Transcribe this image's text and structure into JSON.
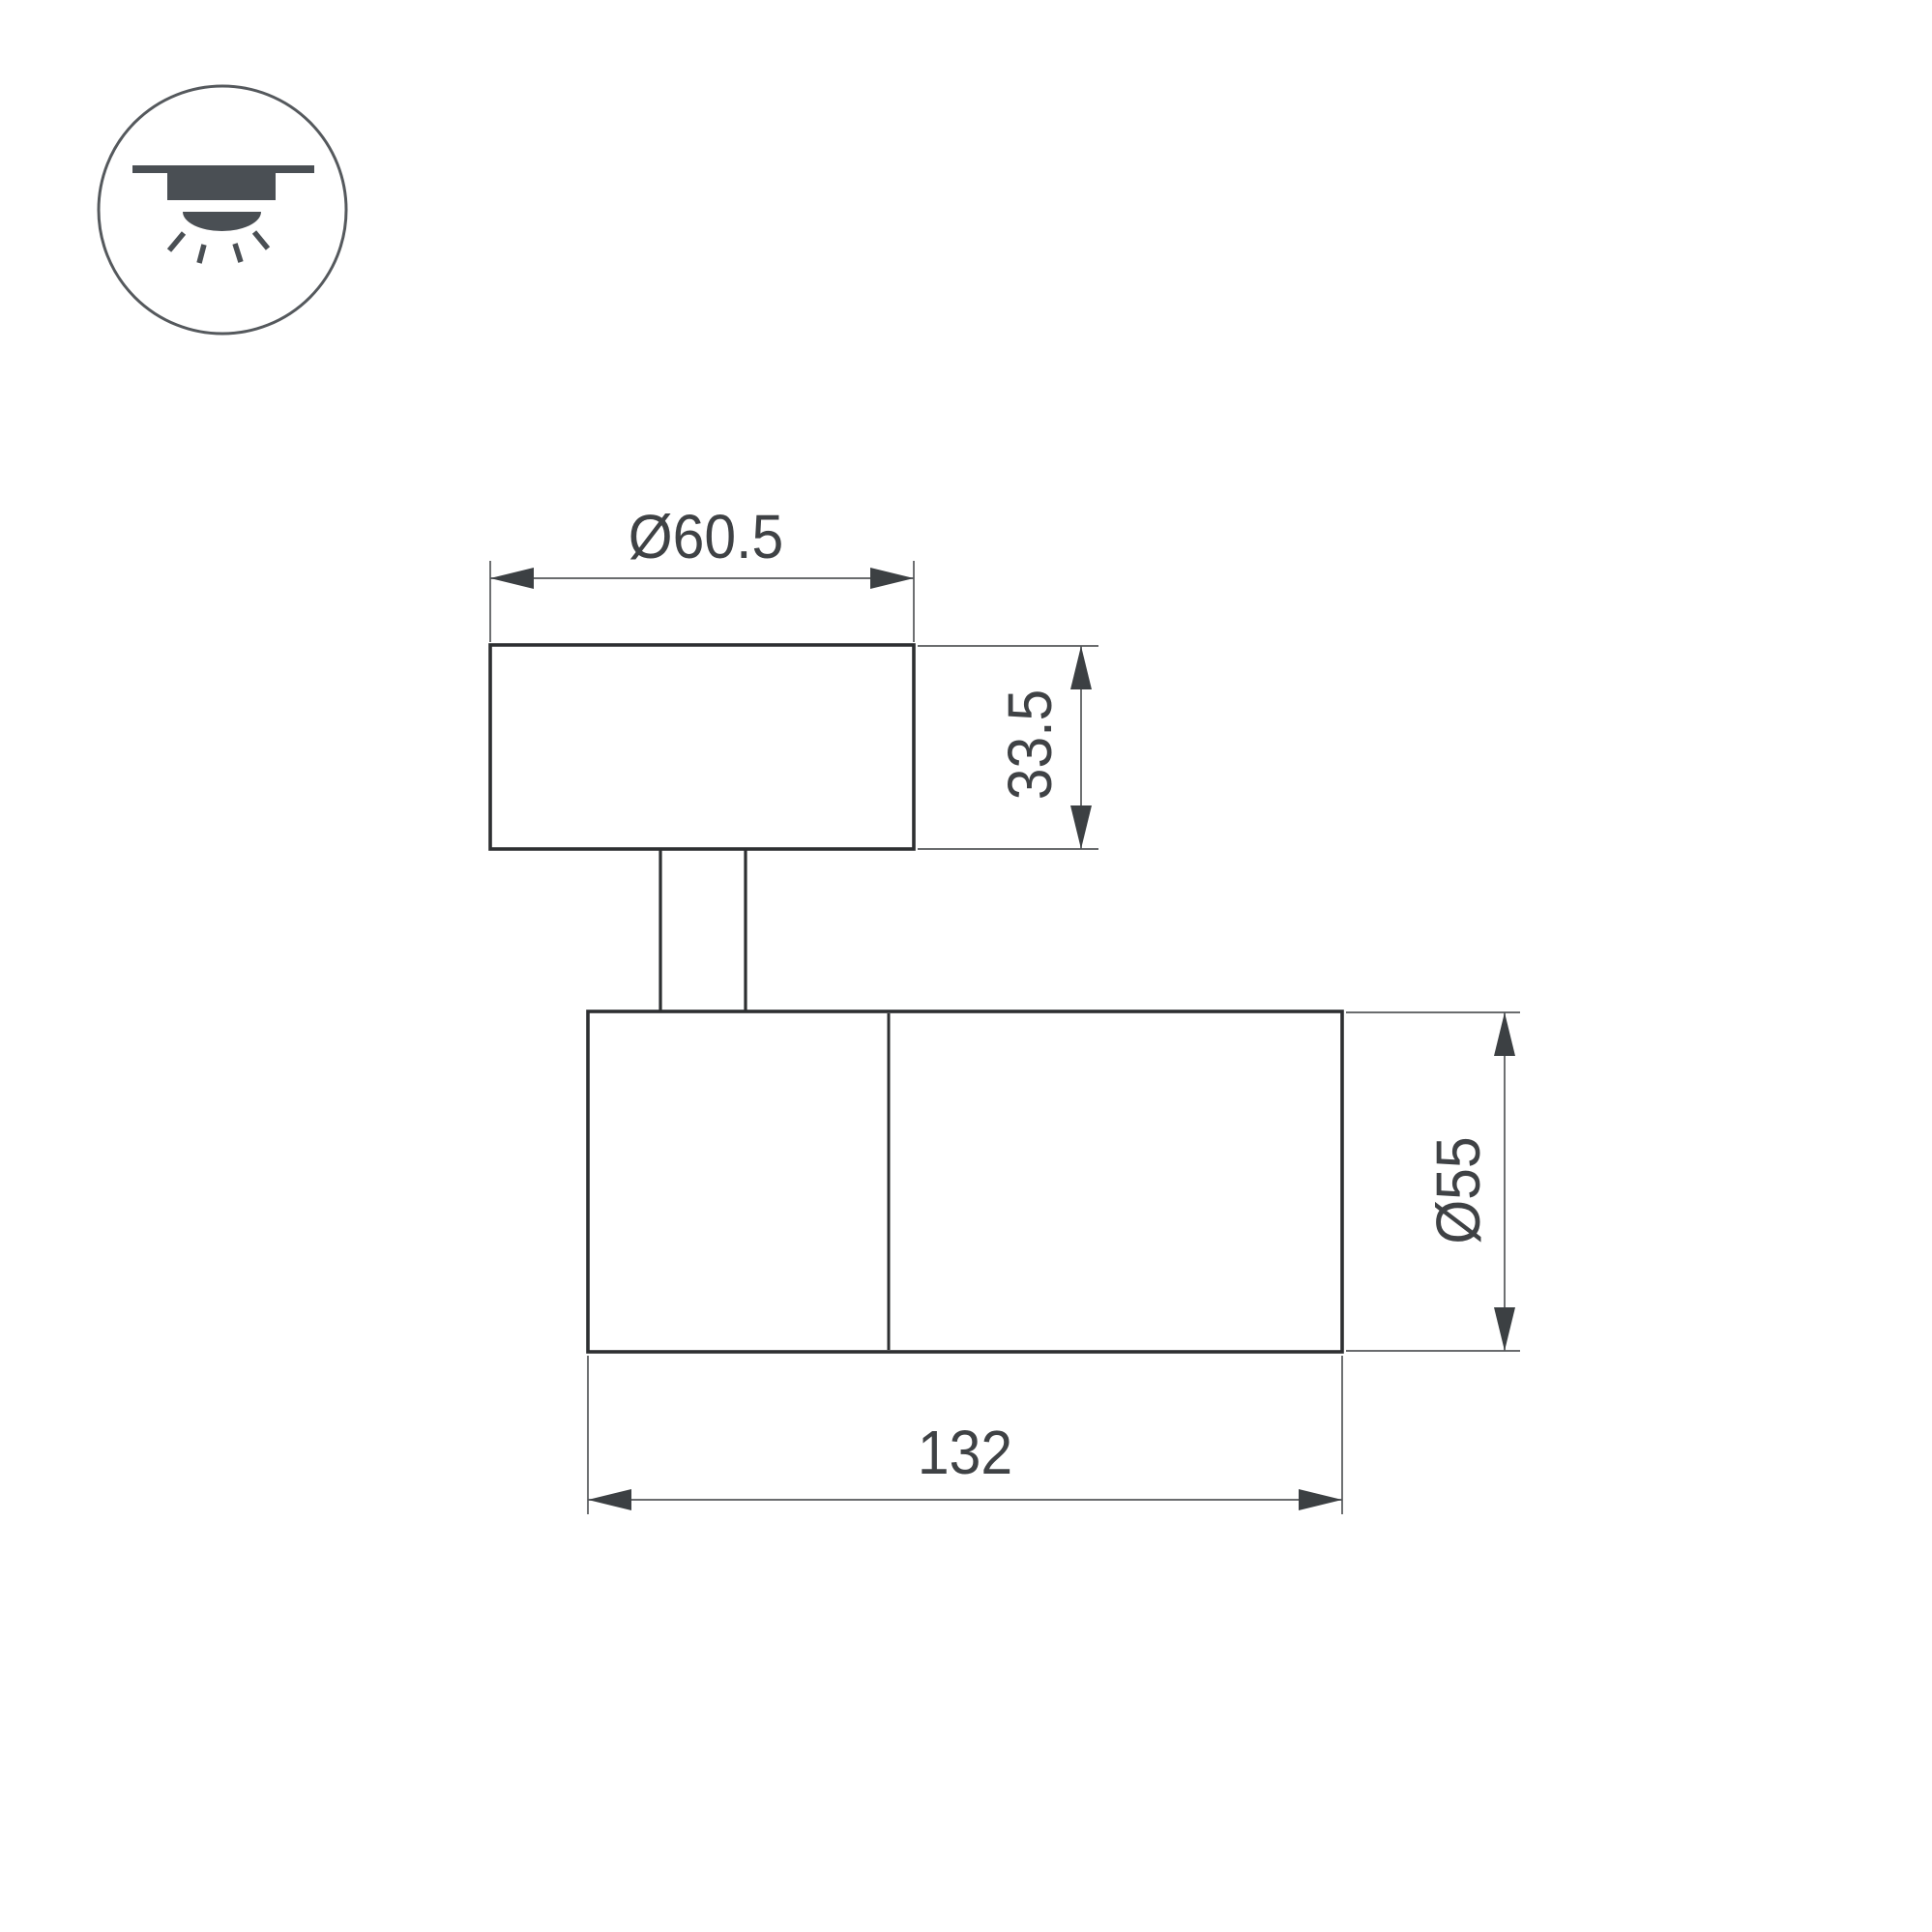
{
  "drawing": {
    "kind": "technical-dimension-drawing",
    "subject": "surface-mounted adjustable spot luminaire, side view",
    "icon": {
      "name": "ceiling-surface-mount-light-icon"
    },
    "dimensions": {
      "base_diameter": "Ø60.5",
      "base_height": "33.5",
      "body_diameter": "Ø55",
      "body_length": "132"
    },
    "colors": {
      "background": "#ffffff",
      "outline": "#2d2f31",
      "dimension_line": "#54575a",
      "arrow": "#3c4043",
      "text": "#3f4245",
      "icon": "#4a4f54"
    }
  }
}
